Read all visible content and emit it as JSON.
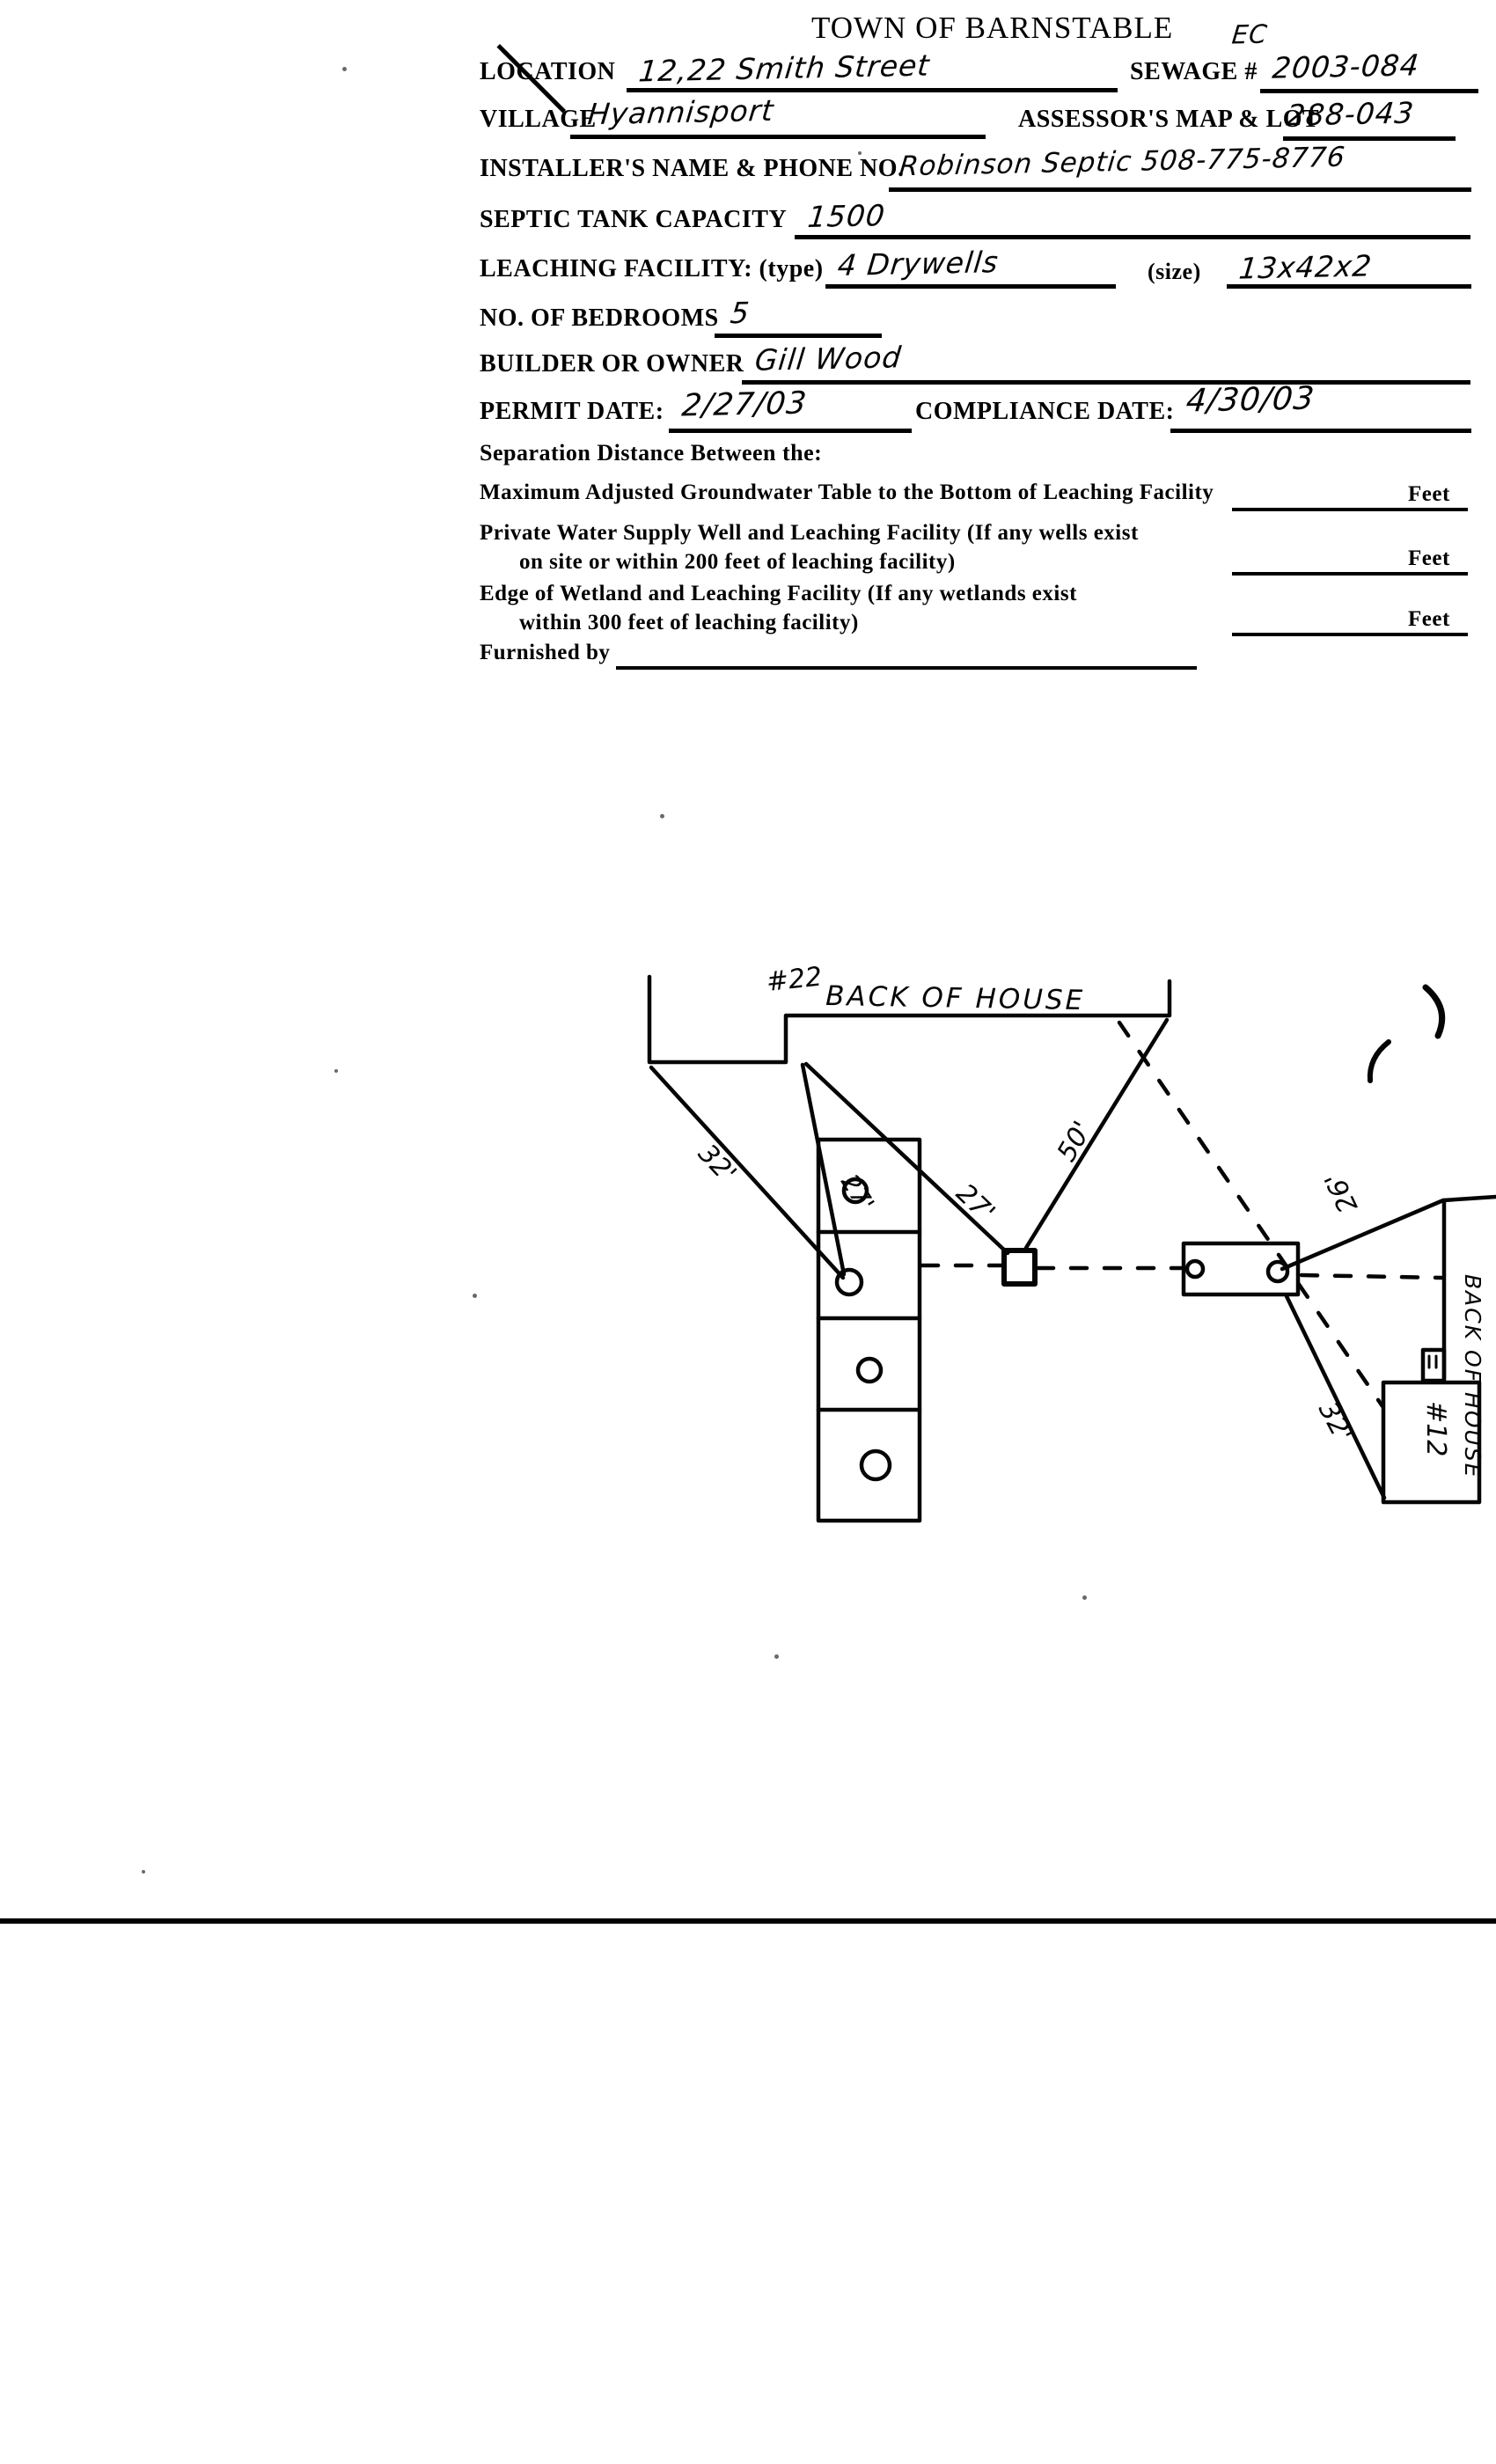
{
  "page": {
    "title": "TOWN OF BARNSTABLE",
    "corner_note": "EC"
  },
  "form": {
    "location": {
      "label": "LOCATION",
      "value": "12,22 Smith Street"
    },
    "sewage": {
      "label": "SEWAGE #",
      "value": "2003-084"
    },
    "village": {
      "label": "VILLAGE",
      "value": "Hyannisport"
    },
    "assessors": {
      "label": "ASSESSOR'S MAP & LOT",
      "value": "288-043"
    },
    "installer": {
      "label": "INSTALLER'S NAME & PHONE NO.",
      "value": "Robinson Septic 508-775-8776"
    },
    "septic_capacity": {
      "label": "SEPTIC TANK CAPACITY",
      "value": "1500"
    },
    "leaching": {
      "label": "LEACHING FACILITY: (type)",
      "value": "4 Drywells",
      "size_label": "(size)",
      "size_value": "13x42x2"
    },
    "bedrooms": {
      "label": "NO. OF BEDROOMS",
      "value": "5"
    },
    "builder": {
      "label": "BUILDER OR OWNER",
      "value": "Gill Wood"
    },
    "permit_date": {
      "label": "PERMIT DATE:",
      "value": "2/27/03"
    },
    "compliance_date": {
      "label": "COMPLIANCE DATE:",
      "value": "4/30/03"
    },
    "separation_heading": "Separation Distance Between the:",
    "separation_rows": [
      {
        "line1": "Maximum Adjusted Groundwater Table to the Bottom of Leaching Facility",
        "line2": "",
        "unit": "Feet",
        "value": ""
      },
      {
        "line1": "Private Water Supply Well and Leaching Facility  (If any wells exist",
        "line2": "on site or within 200 feet of leaching facility)",
        "unit": "Feet",
        "value": ""
      },
      {
        "line1": "Edge of Wetland and Leaching Facility (If any wetlands exist",
        "line2": "within 300 feet of leaching facility)",
        "unit": "Feet",
        "value": ""
      }
    ],
    "furnished_by": {
      "label": "Furnished by",
      "value": ""
    }
  },
  "sketch": {
    "house_top_number": "#22",
    "house_top_label": "BACK OF HOUSE",
    "house_right_number": "#12",
    "house_right_label": "BACK OF HOUSE",
    "dimensions": {
      "house_to_drywell_left": "32'",
      "house_to_drywell_inner": "27'",
      "house_to_dbox": "27'",
      "dbox_to_house_corner": "50'",
      "tank_to_house2_upper": "26'",
      "tank_to_house2_lower": "32'"
    }
  }
}
